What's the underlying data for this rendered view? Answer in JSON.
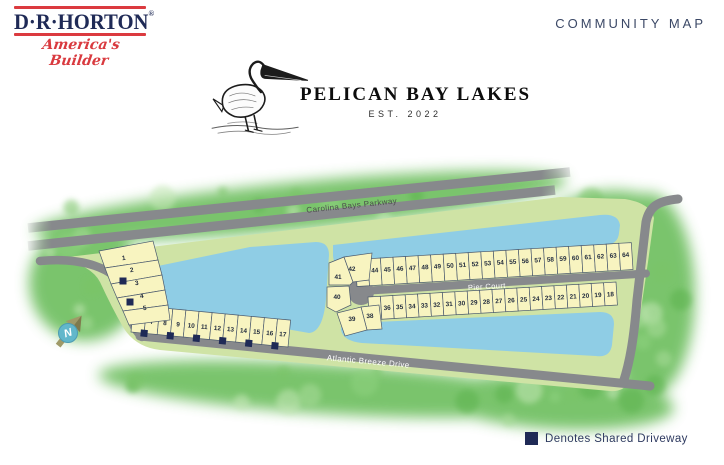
{
  "header": {
    "logo": {
      "wordmark": "D·R·HORTON",
      "registered": "®",
      "tagline": "America's Builder"
    },
    "community_map_label": "COMMUNITY MAP"
  },
  "title": {
    "name": "PELICAN BAY LAKES",
    "est": "EST. 2022"
  },
  "map": {
    "street_labels": {
      "parkway": "Carolina Bays Parkway",
      "pier": "Pier Court",
      "atlantic": "Atlantic Breeze Drive"
    },
    "compass": {
      "label": "N"
    },
    "lot_groups": {
      "fan_west": [
        "1",
        "2",
        "3",
        "4",
        "5"
      ],
      "atlantic_row": [
        "6",
        "7",
        "8",
        "9",
        "10",
        "11",
        "12",
        "13",
        "14",
        "15",
        "16",
        "17"
      ],
      "cul_de_sac_west": [
        "38",
        "39",
        "40",
        "41",
        "42"
      ],
      "pier_north_row": [
        "43",
        "44",
        "45",
        "46",
        "47",
        "48",
        "49",
        "50",
        "51",
        "52",
        "53",
        "54",
        "55",
        "56",
        "57",
        "58",
        "59",
        "60",
        "61",
        "62",
        "63",
        "64"
      ],
      "pier_south_row": [
        "37",
        "36",
        "35",
        "34",
        "33",
        "32",
        "31",
        "30",
        "29",
        "28",
        "27",
        "26",
        "25",
        "24",
        "23",
        "22",
        "21",
        "20",
        "19",
        "18"
      ]
    }
  },
  "legend": {
    "label": "Denotes Shared Driveway",
    "swatch_color": "#1f2a56"
  },
  "colors": {
    "navy": "#1f2a56",
    "brand_red": "#db3a3f",
    "road_gray": "#87898c",
    "lake_blue": "#8fcde5",
    "parcel_green": "#cfe3a5",
    "outer_green": "#68bc58",
    "lot_fill": "#f8f4c0",
    "lot_stroke": "#4b5a6e",
    "compass_teal": "#62b7cb",
    "compass_khaki": "#9f9a68"
  }
}
